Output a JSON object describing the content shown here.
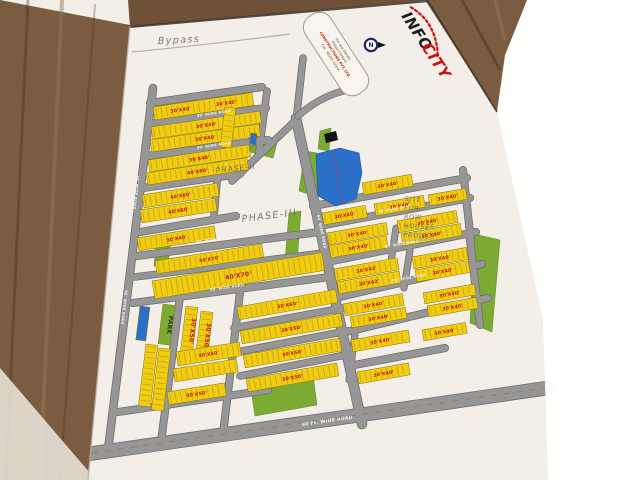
{
  "logo": {
    "part1": "INFO",
    "part2": "CITY",
    "accent": "#cc1111"
  },
  "stamp": {
    "line1": "For any Details",
    "line2": "Please Contact",
    "line3": "CONSTRUCTIONS PVT. LTD.",
    "line4": "Cell : 98XXX XXXXX"
  },
  "compass": {
    "label": "N"
  },
  "annotations": {
    "bypass": "Bypass",
    "phase2": "PHASE-II",
    "phase3": "PHASE-III",
    "site_note": [
      "SITE",
      "FOR",
      "ROW",
      "HOUSES",
      "PROJECT"
    ]
  },
  "map": {
    "colors": {
      "plot_yellow": "#f0cd12",
      "plot_label_red": "#c4150c",
      "road_gray": "#969696",
      "road_casing": "#6e6e6e",
      "green": "#7cab33",
      "water_blue": "#2a6fc9",
      "pencil": "#6f675e",
      "paper": "#f3efe8",
      "wood": "#7b5c41"
    },
    "roads": [
      {
        "x1": 153,
        "y1": 88,
        "x2": 108,
        "y2": 450,
        "w": 7
      },
      {
        "x1": 150,
        "y1": 103,
        "x2": 262,
        "y2": 87,
        "w": 6.5
      },
      {
        "x1": 149,
        "y1": 124,
        "x2": 266,
        "y2": 108,
        "w": 6.5
      },
      {
        "x1": 147,
        "y1": 156,
        "x2": 268,
        "y2": 140,
        "w": 6.5
      },
      {
        "x1": 143,
        "y1": 188,
        "x2": 240,
        "y2": 174,
        "w": 6.5
      },
      {
        "x1": 140,
        "y1": 232,
        "x2": 236,
        "y2": 216,
        "w": 6.5
      },
      {
        "x1": 137,
        "y1": 256,
        "x2": 319,
        "y2": 232,
        "w": 6.5
      },
      {
        "x1": 135,
        "y1": 277,
        "x2": 323,
        "y2": 253,
        "w": 6
      },
      {
        "x1": 133,
        "y1": 303,
        "x2": 329,
        "y2": 277,
        "w": 6.5
      },
      {
        "x1": 234,
        "y1": 328,
        "x2": 343,
        "y2": 308,
        "w": 6
      },
      {
        "x1": 237,
        "y1": 352,
        "x2": 347,
        "y2": 331,
        "w": 6
      },
      {
        "x1": 240,
        "y1": 376,
        "x2": 350,
        "y2": 354,
        "w": 6
      },
      {
        "x1": 118,
        "y1": 412,
        "x2": 268,
        "y2": 390,
        "w": 6.5
      },
      {
        "x1": 180,
        "y1": 296,
        "x2": 161,
        "y2": 442,
        "w": 6.5
      },
      {
        "x1": 240,
        "y1": 292,
        "x2": 223,
        "y2": 434,
        "w": 6.5
      },
      {
        "x1": 296,
        "y1": 118,
        "x2": 362,
        "y2": 424,
        "w": 9
      },
      {
        "x1": 303,
        "y1": 58,
        "x2": 296,
        "y2": 122,
        "w": 6
      },
      {
        "x1": 296,
        "y1": 120,
        "x2": 232,
        "y2": 181,
        "w": 6
      },
      {
        "x1": 224,
        "y1": 104,
        "x2": 214,
        "y2": 216,
        "w": 6
      },
      {
        "x1": 267,
        "y1": 91,
        "x2": 259,
        "y2": 152,
        "w": 6
      },
      {
        "x1": 313,
        "y1": 206,
        "x2": 467,
        "y2": 178,
        "w": 6.5
      },
      {
        "x1": 319,
        "y1": 226,
        "x2": 470,
        "y2": 198,
        "w": 6.5
      },
      {
        "x1": 327,
        "y1": 262,
        "x2": 476,
        "y2": 232,
        "w": 6.5
      },
      {
        "x1": 335,
        "y1": 298,
        "x2": 482,
        "y2": 264,
        "w": 6.5
      },
      {
        "x1": 342,
        "y1": 333,
        "x2": 488,
        "y2": 298,
        "w": 6.5
      },
      {
        "x1": 349,
        "y1": 366,
        "x2": 445,
        "y2": 348,
        "w": 6.5
      },
      {
        "x1": 396,
        "y1": 228,
        "x2": 390,
        "y2": 268,
        "w": 5.5
      },
      {
        "x1": 410,
        "y1": 250,
        "x2": 404,
        "y2": 288,
        "w": 5.5
      },
      {
        "x1": 470,
        "y1": 240,
        "x2": 480,
        "y2": 325,
        "w": 6.5
      },
      {
        "x1": 463,
        "y1": 170,
        "x2": 471,
        "y2": 242,
        "w": 6.5
      },
      {
        "x1": 355,
        "y1": 334,
        "x2": 349,
        "y2": 380,
        "w": 5.5
      },
      {
        "x1": 88,
        "y1": 454,
        "x2": 548,
        "y2": 388,
        "w": 13
      }
    ],
    "road_labels": [
      {
        "x": 197,
        "y": 117,
        "rot": -8.5,
        "t": "30' WIDE ROAD"
      },
      {
        "x": 197,
        "y": 149,
        "rot": -8.5,
        "t": "30' WIDE ROAD"
      },
      {
        "x": 196,
        "y": 243,
        "rot": -8.5,
        "t": "30' WIDE ROAD"
      },
      {
        "x": 210,
        "y": 291,
        "rot": -8.5,
        "t": "30' WIDE ROAD"
      },
      {
        "x": 137,
        "y": 175,
        "rot": 96.5,
        "t": "30' WIDE ROAD"
      },
      {
        "x": 125,
        "y": 290,
        "rot": 96.5,
        "t": "30' WIDE ROAD"
      },
      {
        "x": 317,
        "y": 215,
        "rot": 78,
        "t": "60' WIDE ROAD"
      },
      {
        "x": 378,
        "y": 213,
        "rot": -10.3,
        "t": "30' WIDE ROAD"
      },
      {
        "x": 385,
        "y": 248,
        "rot": -10.3,
        "t": "30' WIDE ROAD"
      },
      {
        "x": 392,
        "y": 282,
        "rot": -10.3,
        "t": "30' WIDE ROAD"
      },
      {
        "x": 302,
        "y": 426,
        "rot": -8.2,
        "t": "60 Ft. WIDE ROAD",
        "s": 4.6
      }
    ],
    "plots": [
      {
        "x": 153,
        "y": 107,
        "w": 100,
        "h": 13,
        "rot": -8.3,
        "label": "30'X40'",
        "label2": "30'X40'"
      },
      {
        "x": 151,
        "y": 127,
        "w": 110,
        "h": 12,
        "rot": -8.3,
        "label": "30'X40'"
      },
      {
        "x": 150,
        "y": 140,
        "w": 110,
        "h": 12,
        "rot": -8.3,
        "label": "30'X40'"
      },
      {
        "x": 148,
        "y": 160,
        "w": 102,
        "h": 12,
        "rot": -8.6,
        "label": "30'X40'"
      },
      {
        "x": 146,
        "y": 173,
        "w": 102,
        "h": 12,
        "rot": -8.6,
        "label": "40'X60'"
      },
      {
        "x": 142,
        "y": 195,
        "w": 76,
        "h": 13,
        "rot": -9,
        "label": "40'X60'"
      },
      {
        "x": 140,
        "y": 210,
        "w": 76,
        "h": 13,
        "rot": -9,
        "label": "40'X60'"
      },
      {
        "x": 137,
        "y": 238,
        "w": 78,
        "h": 13,
        "rot": -9,
        "label": "30'X40'"
      },
      {
        "x": 225,
        "y": 107,
        "w": 11,
        "h": 40,
        "rot": 7
      },
      {
        "x": 155,
        "y": 261,
        "w": 108,
        "h": 13,
        "rot": -9,
        "label": "30'X70'"
      },
      {
        "x": 152,
        "y": 281,
        "w": 172,
        "h": 18,
        "rot": -9.5,
        "label": "40'X70'"
      },
      {
        "x": 237,
        "y": 307,
        "w": 100,
        "h": 13,
        "rot": -10,
        "label": "30'X60'"
      },
      {
        "x": 240,
        "y": 331,
        "w": 102,
        "h": 13,
        "rot": -10,
        "label": "30'X50'"
      },
      {
        "x": 243,
        "y": 355,
        "w": 98,
        "h": 13,
        "rot": -10,
        "label": "30'X50'"
      },
      {
        "x": 246,
        "y": 379,
        "w": 92,
        "h": 13,
        "rot": -10,
        "label": "30'X50'"
      },
      {
        "x": 186,
        "y": 306,
        "w": 12,
        "h": 48,
        "rot": 7,
        "label": "30'X50'"
      },
      {
        "x": 201,
        "y": 311,
        "w": 12,
        "h": 48,
        "rot": 7,
        "label": "30'X50'"
      },
      {
        "x": 176,
        "y": 352,
        "w": 64,
        "h": 14,
        "rot": -9,
        "label": "30'X50'"
      },
      {
        "x": 173,
        "y": 369,
        "w": 64,
        "h": 13,
        "rot": -9
      },
      {
        "x": 167,
        "y": 392,
        "w": 58,
        "h": 13,
        "rot": -9,
        "label": "30'X50'"
      },
      {
        "x": 146,
        "y": 344,
        "w": 12,
        "h": 62,
        "rot": 7
      },
      {
        "x": 159,
        "y": 348,
        "w": 12,
        "h": 62,
        "rot": 7
      },
      {
        "x": 140,
        "y": 306,
        "w": 10,
        "h": 34,
        "rot": 7,
        "fill": "#2a6fc9"
      },
      {
        "x": 163,
        "y": 304,
        "w": 12,
        "h": 40,
        "rot": 7,
        "fill": "#7cab33",
        "label": "PARK",
        "label_color": "#2e3a12"
      },
      {
        "x": 251,
        "y": 133,
        "w": 6,
        "h": 11,
        "rot": 7,
        "fill": "#2a6fc9"
      },
      {
        "x": 362,
        "y": 183,
        "w": 50,
        "h": 12,
        "rot": -10,
        "label": "30'X40'"
      },
      {
        "x": 322,
        "y": 213,
        "w": 44,
        "h": 12,
        "rot": -10,
        "label": "30'X40'"
      },
      {
        "x": 374,
        "y": 204,
        "w": 50,
        "h": 12,
        "rot": -10,
        "label": "30'X40'"
      },
      {
        "x": 428,
        "y": 195,
        "w": 38,
        "h": 11,
        "rot": -10,
        "label": "30'X40'"
      },
      {
        "x": 327,
        "y": 233,
        "w": 60,
        "h": 12,
        "rot": -10,
        "label": "30'X40'"
      },
      {
        "x": 329,
        "y": 246,
        "w": 58,
        "h": 12,
        "rot": -10,
        "label": "30'X40'"
      },
      {
        "x": 397,
        "y": 221,
        "w": 60,
        "h": 12,
        "rot": -10,
        "label": "30'X40'"
      },
      {
        "x": 401,
        "y": 234,
        "w": 60,
        "h": 12,
        "rot": -10,
        "label": "30'X40'"
      },
      {
        "x": 334,
        "y": 269,
        "w": 64,
        "h": 12,
        "rot": -10,
        "label": "30'X42'"
      },
      {
        "x": 337,
        "y": 282,
        "w": 63,
        "h": 12,
        "rot": -10,
        "label": "30'X42'"
      },
      {
        "x": 412,
        "y": 257,
        "w": 55,
        "h": 12,
        "rot": -10,
        "label": "30'X40'"
      },
      {
        "x": 415,
        "y": 270,
        "w": 54,
        "h": 12,
        "rot": -10,
        "label": "30'X40'"
      },
      {
        "x": 343,
        "y": 304,
        "w": 60,
        "h": 12,
        "rot": -10,
        "label": "30'X40'"
      },
      {
        "x": 350,
        "y": 317,
        "w": 56,
        "h": 11,
        "rot": -10,
        "label": "30'X40'"
      },
      {
        "x": 423,
        "y": 293,
        "w": 52,
        "h": 11,
        "rot": -10,
        "label": "30'X40'"
      },
      {
        "x": 427,
        "y": 306,
        "w": 50,
        "h": 11,
        "rot": -10,
        "label": "30'X40'"
      },
      {
        "x": 351,
        "y": 340,
        "w": 58,
        "h": 12,
        "rot": -10,
        "label": "30'X40'"
      },
      {
        "x": 422,
        "y": 330,
        "w": 44,
        "h": 11,
        "rot": -10,
        "label": "30'X40'"
      },
      {
        "x": 357,
        "y": 372,
        "w": 52,
        "h": 12,
        "rot": -10,
        "label": "30'X40'"
      }
    ],
    "greens": [
      {
        "points": "248,133 278,139 273,158 250,152"
      },
      {
        "points": "305,151 317,153 318,197 299,191"
      },
      {
        "points": "474,234 500,240 492,332 470,323"
      },
      {
        "points": "289,213 301,211 297,263 285,260"
      },
      {
        "points": "250,383 313,375 317,405 255,416"
      },
      {
        "points": "320,131 331,128 329,151 318,149"
      },
      {
        "points": "156,244 171,242 168,264 154,266"
      }
    ],
    "pond": {
      "points": "316,154 340,148 359,153 362,173 356,199 336,206 318,196",
      "dash": {
        "x1": 334,
        "y1": 151,
        "x2": 342,
        "y2": 204
      }
    },
    "marks": [
      {
        "points": "324,134 336,131 338,140 326,143",
        "fill": "#15110c"
      }
    ]
  }
}
